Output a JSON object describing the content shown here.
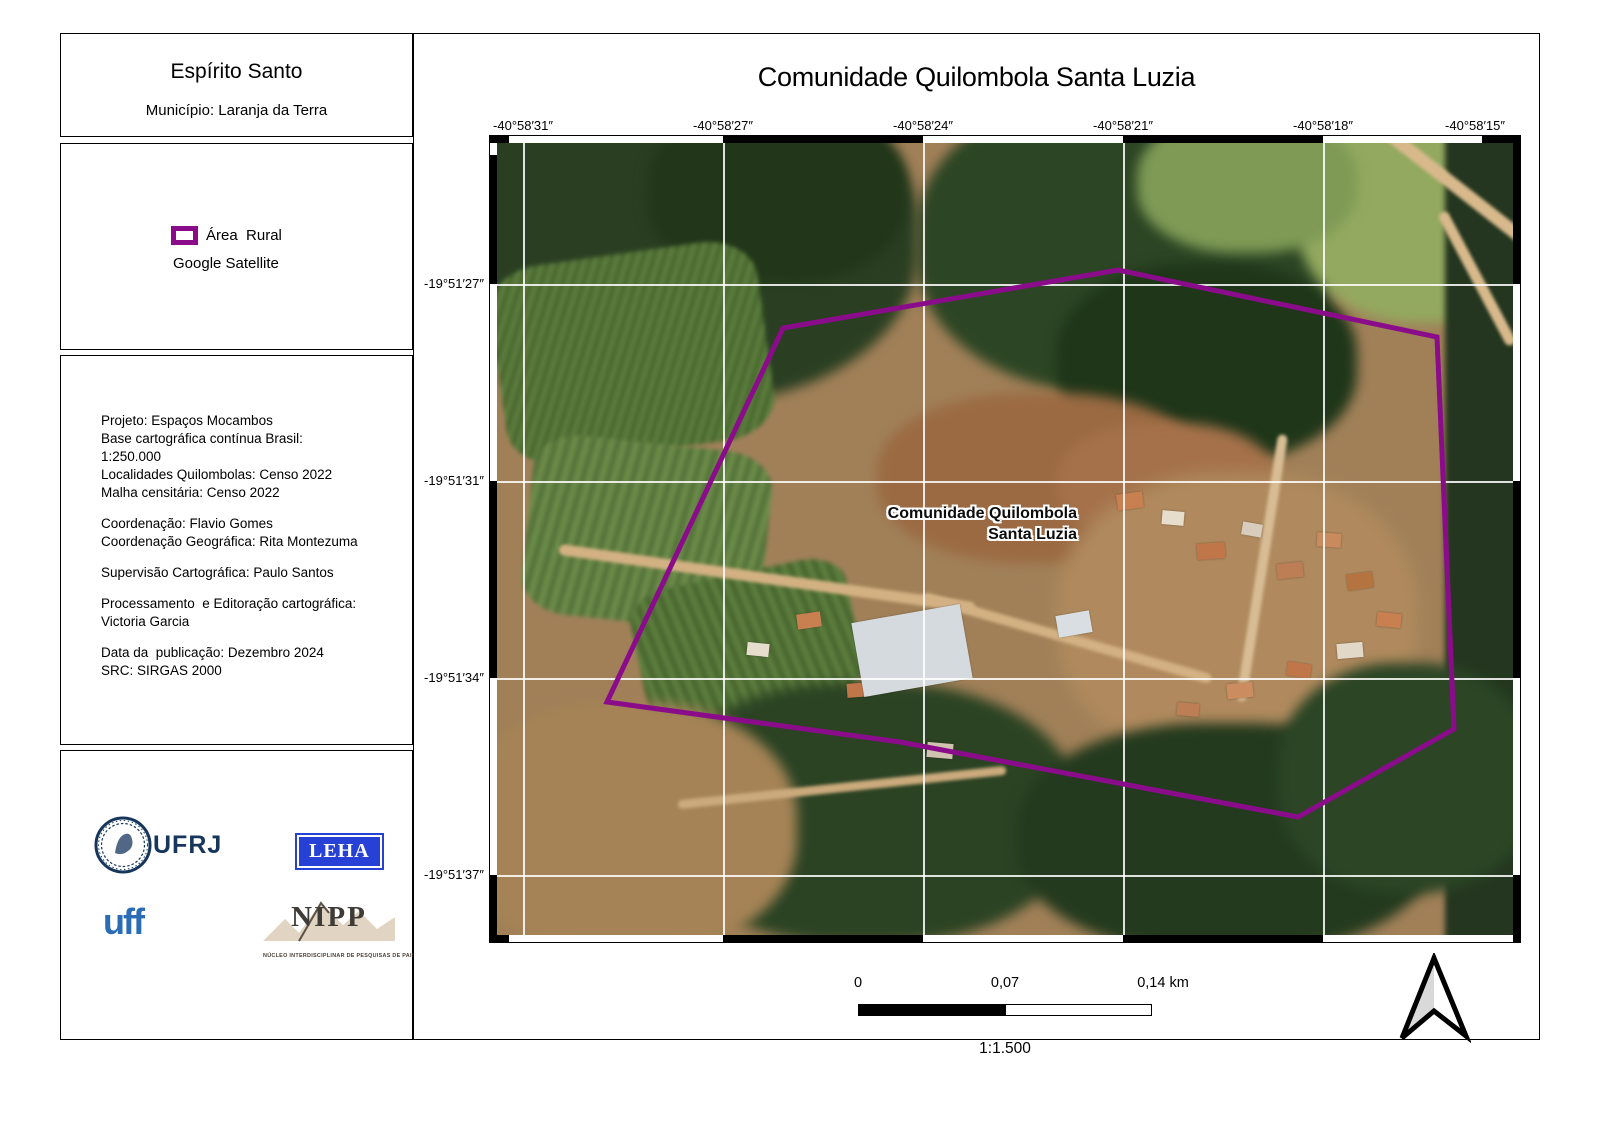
{
  "sidebar": {
    "region": {
      "title": "Espírito Santo",
      "municipality": "Município: Laranja da Terra"
    },
    "legend": {
      "area_label": "Área  Rural",
      "area_color": "#8b0c8b",
      "basemap_label": "Google Satellite"
    },
    "credits_lines": [
      "Projeto: Espaços Mocambos",
      "Base cartográfica contínua Brasil:",
      "1:250.000",
      "Localidades Quilombolas: Censo 2022",
      "Malha censitária: Censo 2022",
      "",
      "Coordenação: Flavio Gomes",
      "Coordenação Geográfica: Rita Montezuma",
      "",
      "Supervisão Cartográfica: Paulo Santos",
      "",
      "Processamento  e Editoração cartográfica:",
      "Victoria Garcia",
      "",
      "Data da  publicação: Dezembro 2024",
      "SRC: SIRGAS 2000"
    ],
    "logos": {
      "ufrj_text": "UFRJ",
      "leha_text": "LEHA",
      "uff_text": "uff",
      "nipp_text": "NIPP",
      "nipp_subtitle": "NÚCLEO INTERDISCIPLINAR DE PESQUISAS DE PAISAGENS"
    }
  },
  "map": {
    "title": "Comunidade Quilombola Santa Luzia",
    "feature_label_line1": "Comunidade Quilombola",
    "feature_label_line2": "Santa Luzia",
    "x_axis": [
      {
        "text": "-40°58′31″",
        "cx": 26
      },
      {
        "text": "-40°58′27″",
        "cx": 226
      },
      {
        "text": "-40°58′24″",
        "cx": 426
      },
      {
        "text": "-40°58′21″",
        "cx": 626
      },
      {
        "text": "-40°58′18″",
        "cx": 826
      },
      {
        "text": "-40°58′15″",
        "cx": 978
      }
    ],
    "y_axis": [
      {
        "text": "-19°51′27″",
        "cy": 141
      },
      {
        "text": "-19°51′31″",
        "cy": 338
      },
      {
        "text": "-19°51′34″",
        "cy": 535
      },
      {
        "text": "-19°51′37″",
        "cy": 732
      }
    ],
    "gridlines": {
      "v": [
        26,
        226,
        426,
        626,
        826
      ],
      "h": [
        141,
        338,
        535,
        732
      ]
    },
    "polygon": {
      "color": "#8b0c8b",
      "points": [
        [
          621,
          127
        ],
        [
          940,
          194
        ],
        [
          957,
          586
        ],
        [
          801,
          674
        ],
        [
          403,
          599
        ],
        [
          110,
          559
        ],
        [
          286,
          185
        ]
      ]
    },
    "scalebar": {
      "zero": "0",
      "mid": "0,07",
      "end": "0,14 km",
      "scale_text": "1:1.500"
    }
  }
}
